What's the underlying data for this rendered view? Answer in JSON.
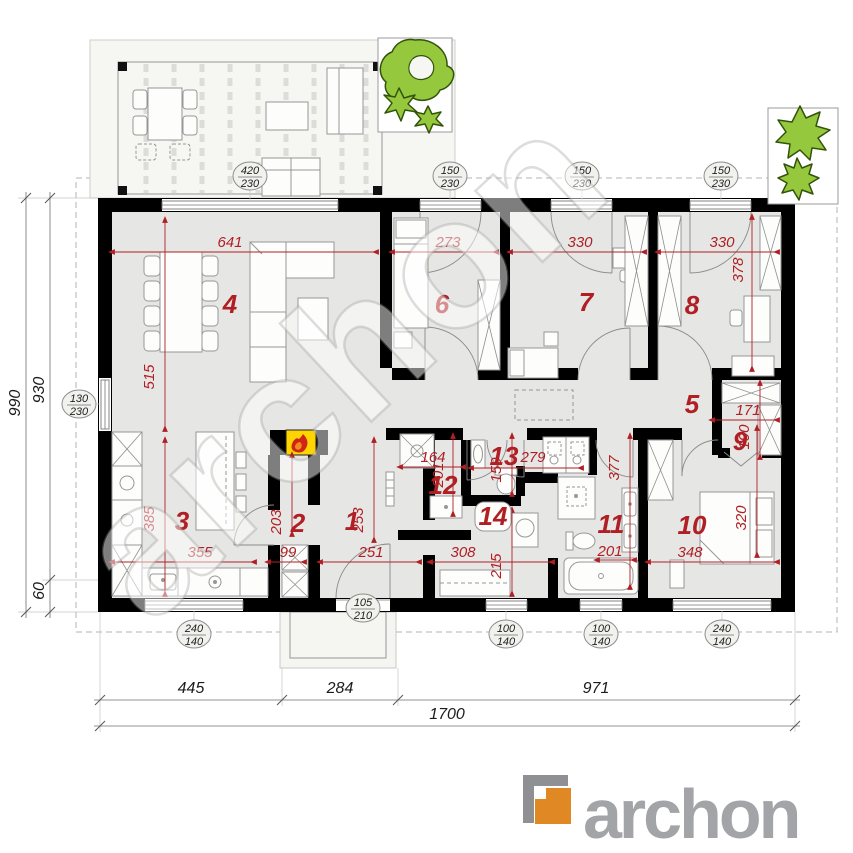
{
  "colors": {
    "red": "#b01f24",
    "wall": "#000000",
    "floor": "#e6e6e4",
    "tree_green": "#96c83e",
    "logo_orange": "#e08824",
    "logo_gray": "#a2a4a7"
  },
  "watermark_text": "archon",
  "logo_text": "archon",
  "room_labels": [
    "1",
    "2",
    "3",
    "4",
    "5",
    "6",
    "7",
    "8",
    "9",
    "10",
    "11",
    "12",
    "13",
    "14"
  ],
  "red_dims": [
    "641",
    "515",
    "273",
    "330",
    "330",
    "378",
    "385",
    "355",
    "99",
    "251",
    "253",
    "203",
    "164",
    "201",
    "279",
    "150",
    "308",
    "215",
    "377",
    "201",
    "171",
    "190",
    "348",
    "320"
  ],
  "window_tags": [
    [
      "420",
      "230"
    ],
    [
      "150",
      "230"
    ],
    [
      "150",
      "230"
    ],
    [
      "150",
      "230"
    ],
    [
      "130",
      "230"
    ],
    [
      "240",
      "140"
    ],
    [
      "105",
      "210"
    ],
    [
      "100",
      "140"
    ],
    [
      "100",
      "140"
    ],
    [
      "240",
      "140"
    ]
  ],
  "chain_dims": {
    "bottom": [
      "445",
      "284",
      "971"
    ],
    "total": "1700",
    "left_outer": "990",
    "left_inner": [
      "930",
      "60"
    ]
  }
}
